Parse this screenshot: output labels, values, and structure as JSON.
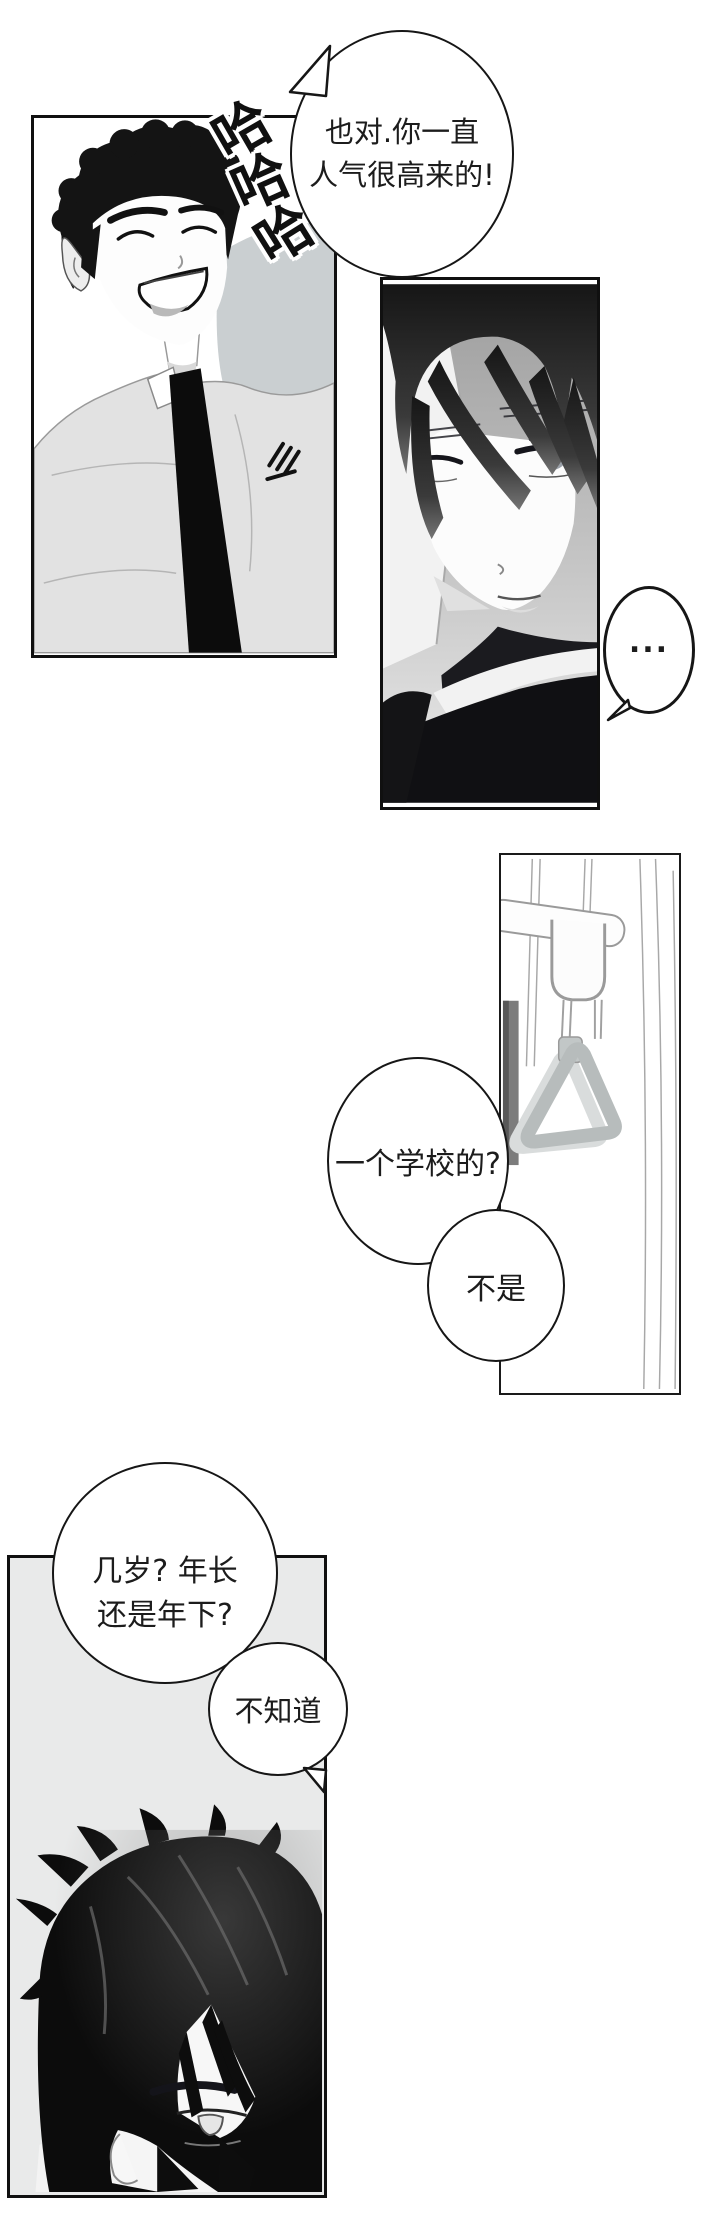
{
  "comic": {
    "sfx_laugh": {
      "char1": "哈",
      "char2": "哈",
      "char3": "哈"
    },
    "bubble_top": {
      "line1": "也对.你一直",
      "line2": "人气很高来的!"
    },
    "bubble_ellipsis": {
      "text": "..."
    },
    "bubble_school": {
      "text": "一个学校的?"
    },
    "bubble_no": {
      "text": "不是"
    },
    "bubble_age": {
      "line1": "几岁? 年长",
      "line2": "还是年下?"
    },
    "bubble_dontknow": {
      "text": "不知道"
    }
  },
  "colors": {
    "ink": "#101010",
    "bubble_border": "#161616",
    "panel4_background": "#e9eaea",
    "jacket_gray": "#e2e2e2",
    "backdrop_gray": "#cacfd1",
    "strap_gray": "#b7bcbc",
    "page_background": "#ffffff"
  }
}
